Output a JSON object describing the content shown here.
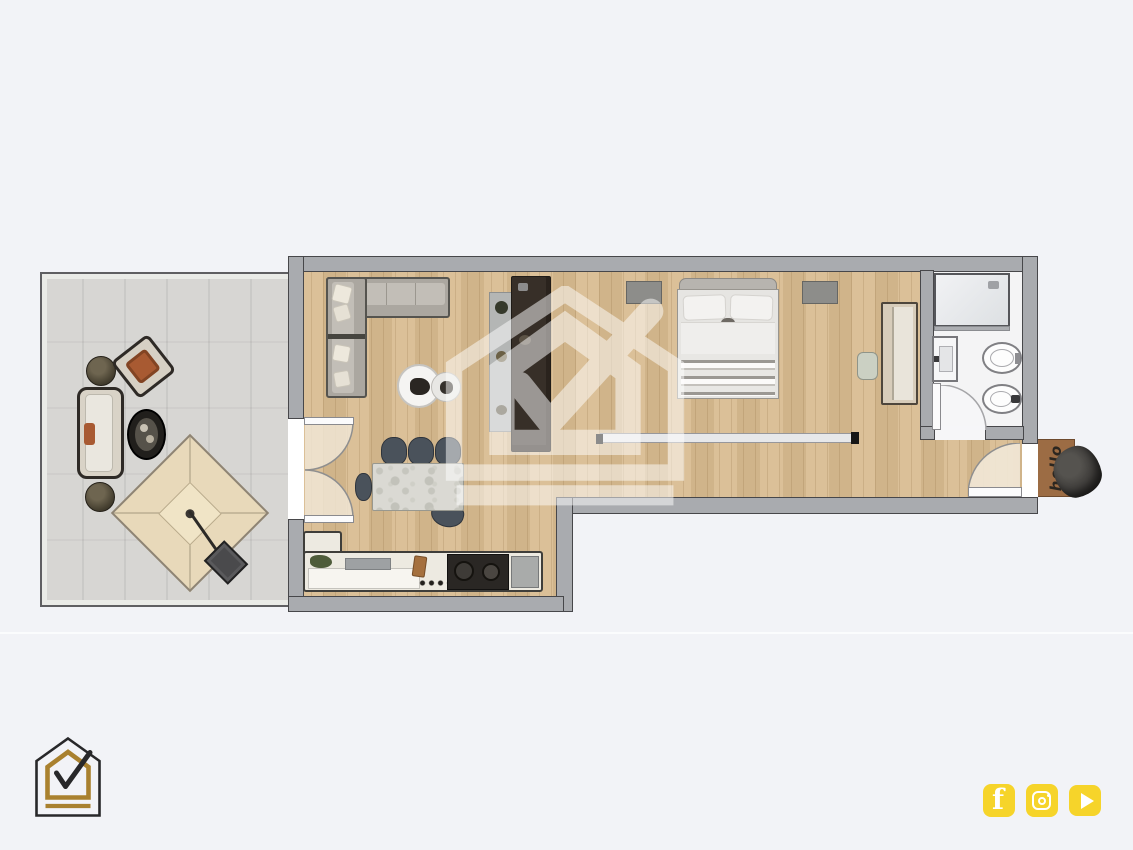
{
  "page": {
    "background_color": "#F2F3F7",
    "divider_line_color": "#FBFCFE"
  },
  "watermark": {
    "icon": "house-check-watermark",
    "color": "#FFFFFF",
    "opacity": 0.5
  },
  "logo": {
    "icon": "house-check-logo",
    "outline_color": "#28282A",
    "accent_color": "#A9812F"
  },
  "social_bar": {
    "button_color": "#F6D42A",
    "icons": [
      {
        "name": "facebook-icon",
        "glyph": "f"
      },
      {
        "name": "instagram-icon",
        "glyph": "camera"
      },
      {
        "name": "youtube-icon",
        "glyph": "play"
      }
    ]
  },
  "floor_plan": {
    "wall_color": "#A9ABAF",
    "wood_floor_color": "#D8BB90",
    "terrace_floor_color": "#D7D6D3",
    "bathroom_floor_color": "#F4F4F5",
    "doormat": {
      "text": "hello",
      "background_color": "#9C6C44"
    },
    "rooms": [
      {
        "name": "terrace",
        "furniture": [
          "outdoor sofa",
          "outdoor chair",
          "plant pot",
          "plant pot",
          "oval coffee table",
          "parasol with base"
        ]
      },
      {
        "name": "living-kitchen",
        "furniture": [
          "corner sofa",
          "round coffee table",
          "round side table",
          "tall dark cabinet",
          "kitchen counter with cooktop",
          "dining table",
          "five chairs",
          "french doors to terrace"
        ]
      },
      {
        "name": "bedroom",
        "furniture": [
          "double bed",
          "nightstand",
          "nightstand",
          "wardrobe",
          "stool",
          "glass partition"
        ]
      },
      {
        "name": "bathroom",
        "furniture": [
          "shower",
          "washbasin",
          "toilet",
          "bidet"
        ]
      },
      {
        "name": "hallway",
        "furniture": [
          "entrance door",
          "doormat",
          "decorative stone"
        ]
      }
    ]
  }
}
